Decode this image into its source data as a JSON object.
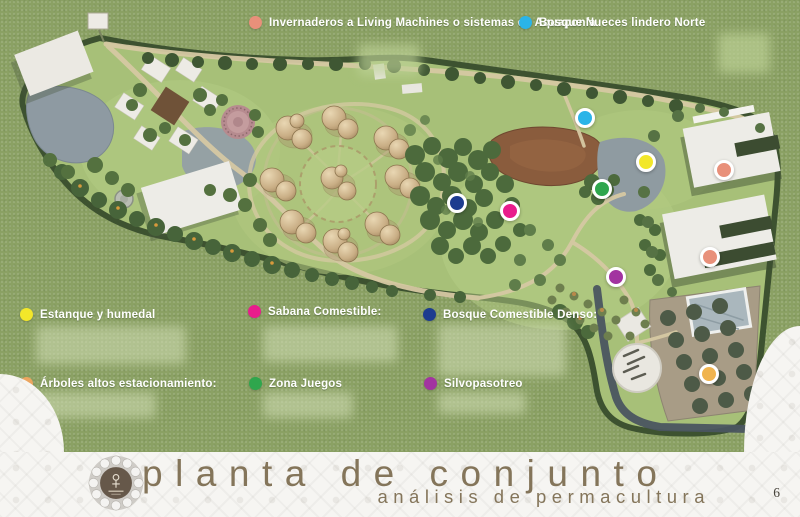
{
  "page": {
    "number": "6"
  },
  "title": {
    "main": "planta de conjunto",
    "subtitle": "análisis de permacultura",
    "text_color": "#84755a"
  },
  "legend_top": [
    {
      "label": "Invernaderos a Living Machines o sistemas de Aquaponía",
      "color": "#e8907a"
    },
    {
      "label": "Bosque Nueces lindero Norte",
      "color": "#2ab4e8"
    }
  ],
  "legend": [
    {
      "label": "Estanque y humedal",
      "color": "#f2e72a"
    },
    {
      "label": "Sabana Comestible:",
      "color": "#e81d8c"
    },
    {
      "label": "Bosque Comestible Denso:",
      "color": "#1d3c8f"
    },
    {
      "label": "Árboles altos estacionamiento:",
      "color": "#eba55f"
    },
    {
      "label": "Zona Juegos",
      "color": "#2fa64d"
    },
    {
      "label": "Silvopasotreo",
      "color": "#a234a0"
    }
  ],
  "map": {
    "markers": [
      {
        "name": "bosque-nueces",
        "color": "#2ab4e8",
        "x": 585,
        "y": 118
      },
      {
        "name": "estanque-humedal",
        "color": "#f2e72a",
        "x": 646,
        "y": 162
      },
      {
        "name": "invernadero-north",
        "color": "#e8907a",
        "x": 724,
        "y": 170
      },
      {
        "name": "zona-juegos",
        "color": "#2fa64d",
        "x": 602,
        "y": 189
      },
      {
        "name": "bosque-comestible-denso",
        "color": "#1d3c8f",
        "x": 457,
        "y": 203
      },
      {
        "name": "sabana-comestible",
        "color": "#e81d8c",
        "x": 510,
        "y": 211
      },
      {
        "name": "invernadero-south",
        "color": "#e8907a",
        "x": 710,
        "y": 257
      },
      {
        "name": "silvopastoreo",
        "color": "#a234a0",
        "x": 616,
        "y": 277
      },
      {
        "name": "arboles-estacionamiento",
        "color": "#f0b44f",
        "x": 709,
        "y": 374
      }
    ]
  }
}
